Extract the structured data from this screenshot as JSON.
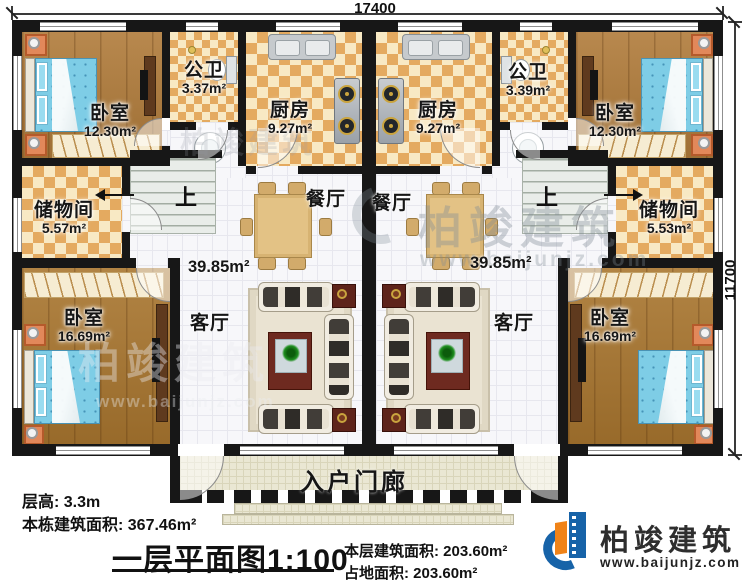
{
  "dimensions": {
    "top": "17400",
    "right": "11700"
  },
  "left_unit": {
    "bedroom_top": {
      "name": "卧室",
      "area": "12.30m²"
    },
    "bathroom": {
      "name": "公卫",
      "area": "3.37m²"
    },
    "kitchen": {
      "name": "厨房",
      "area": "9.27m²"
    },
    "storage": {
      "name": "储物间",
      "area": "5.57m²"
    },
    "bedroom_bottom": {
      "name": "卧室",
      "area": "16.69m²"
    },
    "dining": {
      "name": "餐厅"
    },
    "living": {
      "name": "客厅"
    },
    "living_area": "39.85m²",
    "stairs_up": "上"
  },
  "right_unit": {
    "bedroom_top": {
      "name": "卧室",
      "area": "12.30m²"
    },
    "bathroom": {
      "name": "公卫",
      "area": "3.39m²"
    },
    "kitchen": {
      "name": "厨房",
      "area": "9.27m²"
    },
    "storage": {
      "name": "储物间",
      "area": "5.53m²"
    },
    "bedroom_bottom": {
      "name": "卧室",
      "area": "16.69m²"
    },
    "dining": {
      "name": "餐厅"
    },
    "living": {
      "name": "客厅"
    },
    "living_area": "39.85m²",
    "stairs_up": "上"
  },
  "porch": {
    "name": "入户门廊"
  },
  "title_block": {
    "floor_height": "层高: 3.3m",
    "building_area": "本栋建筑面积: 367.46m²",
    "drawing_title": "一层平面图1:100",
    "floor_area": "本层建筑面积: 203.60m²",
    "footprint_area": "占地面积: 203.60m²"
  },
  "brand": {
    "name": "柏竣建筑",
    "website": "www.baijunjz.com"
  },
  "watermarks": {
    "center_name": "柏竣建筑",
    "center_site": "www.baijunjz.com",
    "left_name": "柏竣建筑",
    "left_site": "www.baijunjz.com",
    "top_name": "柏竣建筑"
  },
  "colors": {
    "wall": "#171717",
    "brand_blue": "#1763a8",
    "brand_orange": "#f08318",
    "bed_blue": "#7ecde6",
    "checker_tan": "#e4aa60"
  }
}
